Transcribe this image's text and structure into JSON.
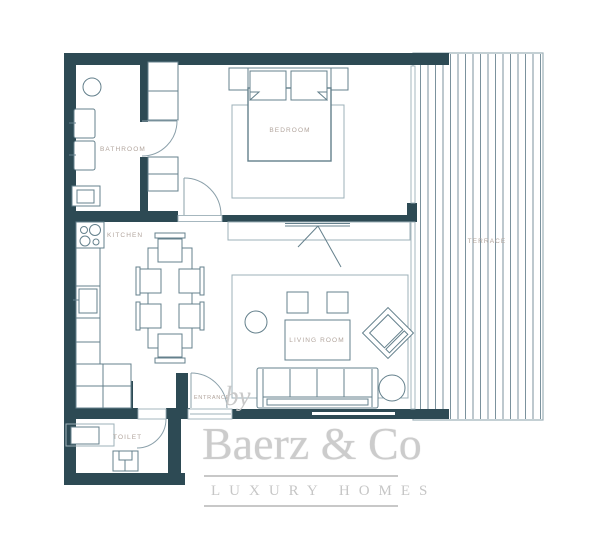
{
  "floor_plan": {
    "rooms": {
      "bathroom": {
        "label": "BATHROOM"
      },
      "bedroom": {
        "label": "BEDROOM"
      },
      "kitchen": {
        "label": "KITCHEN"
      },
      "living_room": {
        "label": "LIVING ROOM"
      },
      "terrace": {
        "label": "TERRACE"
      },
      "entrance": {
        "label": "ENTRANCE"
      },
      "toilet": {
        "label": "TOILET"
      }
    },
    "colors": {
      "wall": "#2d4a54",
      "furniture_line": "#64808c",
      "light_line": "#9db0b8",
      "terrace_stripe": "#7b929d",
      "room_label": "#b2a59d",
      "watermark": "#cbcbcb"
    }
  },
  "watermark": {
    "prefix": "by",
    "brand": "Baerz & Co",
    "tagline": "LUXURY HOMES"
  }
}
